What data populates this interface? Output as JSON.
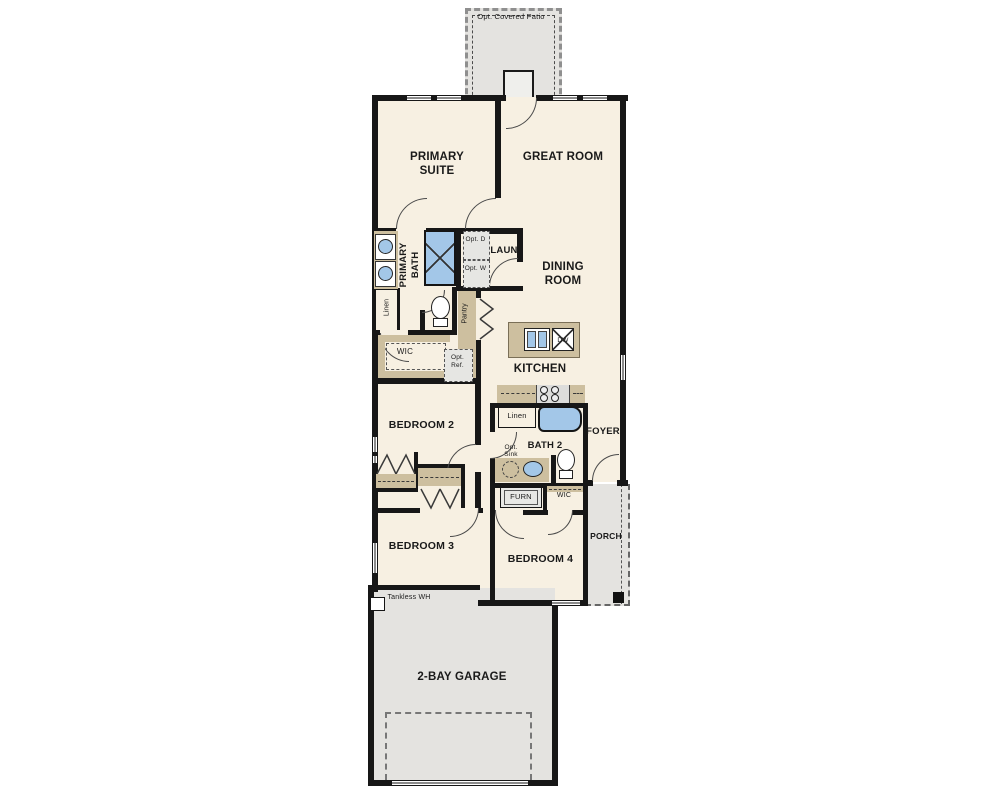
{
  "plan_type": "single-story floor plan",
  "colors": {
    "floor": "#f7f0e2",
    "optional_area": "#e4e3e0",
    "wall": "#171717",
    "counter": "#cdbf9f",
    "fixture_blue": "#a3c7e8",
    "background": "#ffffff"
  },
  "labels": {
    "patio": "Opt. Covered Patio",
    "primary_suite": "PRIMARY SUITE",
    "great_room": "GREAT ROOM",
    "primary_bath": "PRIMARY BATH",
    "opt_dryer": "Opt. D",
    "opt_washer": "Opt. W",
    "laundry": "LAUN",
    "linen_primary": "Linen",
    "pantry": "Pantry",
    "dining_room": "DINING ROOM",
    "wic_primary": "WIC",
    "opt_ref": "Opt. Ref.",
    "kitchen": "KITCHEN",
    "dishwasher": "DW",
    "bedroom2": "BEDROOM 2",
    "linen_bath2": "Linen",
    "bath2": "BATH 2",
    "foyer": "FOYER",
    "opt_sink": "Opt. Sink",
    "furnace": "FURN",
    "wic_bedroom4": "WIC",
    "porch": "PORCH",
    "bedroom3": "BEDROOM 3",
    "bedroom4": "BEDROOM 4",
    "tankless_wh": "Tankless WH",
    "garage": "2-BAY GARAGE"
  }
}
